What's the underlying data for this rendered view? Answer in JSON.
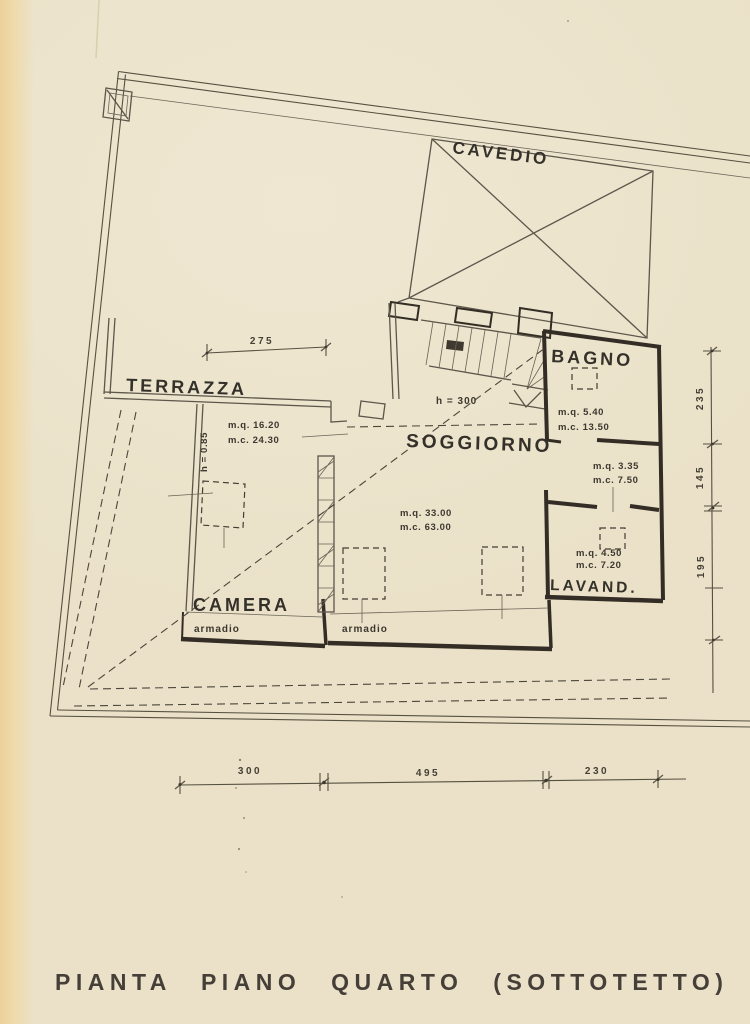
{
  "document": {
    "title": "PIANTA PIANO QUARTO (SOTTOTETTO)"
  },
  "plan": {
    "rooms": {
      "cavedio": {
        "label": "CAVEDIO"
      },
      "terrazza": {
        "label": "TERRAZZA",
        "area": "m.q. 16.20",
        "volume": "m.c. 24.30",
        "height_note": "h = 0.85"
      },
      "soggiorno": {
        "label": "SOGGIORNO",
        "area": "m.q. 33.00",
        "volume": "m.c. 63.00",
        "height_note": "h = 300",
        "closet_label": "armadio"
      },
      "bagno": {
        "label": "BAGNO",
        "area": "m.q. 5.40",
        "volume": "m.c. 13.50"
      },
      "disimpegno": {
        "area": "m.q. 3.35",
        "volume": "m.c. 7.50"
      },
      "lavanderia": {
        "label": "LAVAND.",
        "area": "m.q. 4.50",
        "volume": "m.c. 7.20"
      },
      "camera": {
        "label": "CAMERA",
        "closet_label": "armadio"
      }
    },
    "dimensions": {
      "top_width": "275",
      "right": [
        "235",
        "145",
        "195"
      ],
      "bottom": [
        "300",
        "495",
        "230"
      ]
    }
  },
  "colors": {
    "paper": "#eae1c8",
    "paper_edge": "#ecd29a",
    "ink": "#56503f",
    "ink_heavy": "#332d25",
    "text": "#34302a"
  }
}
